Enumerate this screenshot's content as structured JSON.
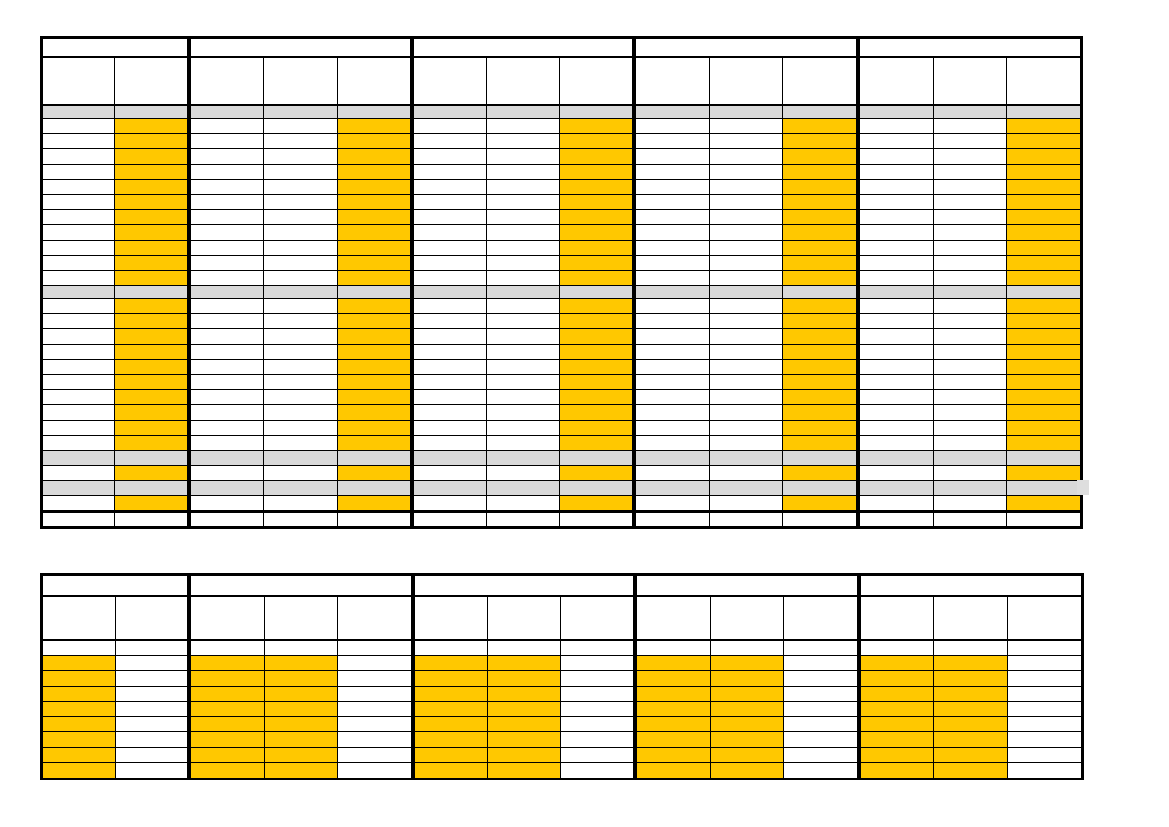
{
  "document": {
    "kind": "blank-schedule-grid-template",
    "visible_text": [],
    "page_background": "#FFFFFF"
  },
  "colors": {
    "grid_line": "#000000",
    "cell_white": "#FFFFFF",
    "highlight_gold": "#FFC800",
    "band_gray": "#D9D9D9",
    "band_tail_gray": "#DEDEDE"
  },
  "tables": [
    {
      "id": "upper-schedule-table",
      "left": 40,
      "top": 36,
      "outer_width": 1043,
      "border_top": 3,
      "border_side": 3,
      "border_bottom": 3,
      "group_separator": 4,
      "cell_line": 1,
      "groups": [
        {
          "columns": 2,
          "width": 147,
          "highlight_columns": [
            1
          ]
        },
        {
          "columns": 3,
          "width": 224,
          "highlight_columns": [
            2
          ]
        },
        {
          "columns": 3,
          "width": 223,
          "highlight_columns": [
            2
          ]
        },
        {
          "columns": 3,
          "width": 224,
          "highlight_columns": [
            2
          ]
        },
        {
          "columns": 3,
          "width": 225,
          "highlight_columns": [
            2
          ]
        }
      ],
      "rows": [
        {
          "kind": "group-band",
          "height": 19,
          "border_bottom": 2
        },
        {
          "kind": "header",
          "height": 48,
          "border_bottom": 2
        },
        {
          "kind": "gray-band",
          "height": 13,
          "border_bottom": 1
        },
        {
          "kind": "data",
          "repeat": 11,
          "height": 15.2,
          "border_bottom": 1,
          "highlight": true
        },
        {
          "kind": "gray-band",
          "height": 13,
          "border_bottom": 1
        },
        {
          "kind": "data",
          "repeat": 10,
          "height": 15.2,
          "border_bottom": 1,
          "highlight": true
        },
        {
          "kind": "gray-band",
          "height": 15,
          "border_bottom": 1
        },
        {
          "kind": "data",
          "height": 15,
          "border_bottom": 1,
          "highlight": true
        },
        {
          "kind": "gray-band",
          "height": 15,
          "border_bottom": 1,
          "tail_right": true
        },
        {
          "kind": "data",
          "height": 17,
          "border_bottom": 3,
          "highlight": true
        },
        {
          "kind": "data",
          "height": 13,
          "border_bottom": 0,
          "highlight": false
        }
      ]
    },
    {
      "id": "lower-schedule-table",
      "left": 40,
      "top": 573,
      "outer_width": 1044,
      "border_top": 3,
      "border_side": 3,
      "border_bottom": 2,
      "group_separator": 4,
      "cell_line": 1,
      "groups": [
        {
          "columns": 2,
          "width": 147,
          "highlight_columns": [
            0
          ]
        },
        {
          "columns": 3,
          "width": 224,
          "highlight_columns": [
            0,
            1
          ]
        },
        {
          "columns": 3,
          "width": 223,
          "highlight_columns": [
            0,
            1
          ]
        },
        {
          "columns": 3,
          "width": 224,
          "highlight_columns": [
            0,
            1
          ]
        },
        {
          "columns": 3,
          "width": 225,
          "highlight_columns": [
            0,
            1
          ]
        }
      ],
      "rows": [
        {
          "kind": "group-band",
          "height": 21,
          "border_bottom": 2
        },
        {
          "kind": "header",
          "height": 44,
          "border_bottom": 2
        },
        {
          "kind": "data",
          "height": 15,
          "border_bottom": 1,
          "highlight": false
        },
        {
          "kind": "data",
          "repeat": 8,
          "height": 15.25,
          "border_bottom": 1,
          "highlight": true
        }
      ]
    }
  ]
}
